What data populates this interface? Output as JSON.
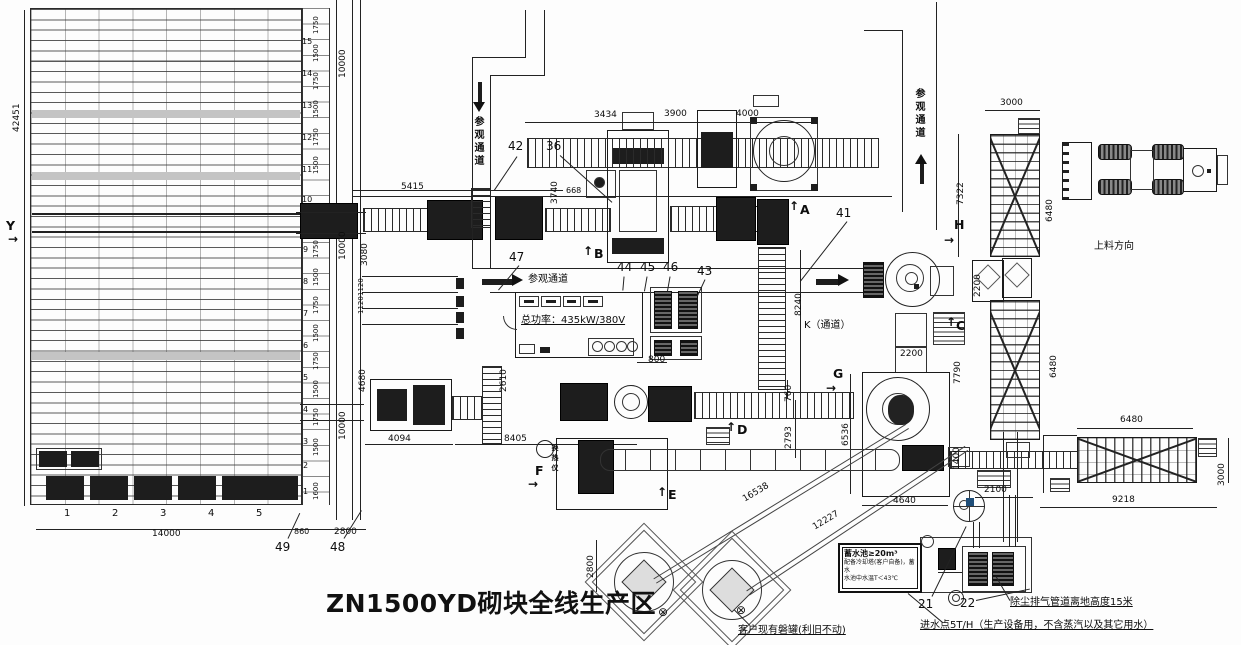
{
  "title": "ZN1500YD砌块全线生产区",
  "labels": {
    "water_box": {
      "l1": "蓄水池≥20m³",
      "l2": "配备冷却塔(客户自备)，蓄水",
      "l3": "水池中水温T＜43℃"
    }
  },
  "annotations": [
    {
      "t": "5415",
      "x": 401,
      "y": 183
    },
    {
      "t": "3434",
      "x": 594,
      "y": 111
    },
    {
      "t": "3900",
      "x": 664,
      "y": 110
    },
    {
      "t": "4000",
      "x": 736,
      "y": 110
    },
    {
      "t": "3000",
      "x": 1000,
      "y": 99
    },
    {
      "t": "2200",
      "x": 900,
      "y": 350
    },
    {
      "t": "800",
      "x": 648,
      "y": 356
    },
    {
      "t": "668",
      "x": 566,
      "y": 187,
      "s": 8
    },
    {
      "t": "2100",
      "x": 984,
      "y": 486
    },
    {
      "t": "4640",
      "x": 893,
      "y": 497
    },
    {
      "t": "4094",
      "x": 388,
      "y": 435
    },
    {
      "t": "8405",
      "x": 504,
      "y": 435
    },
    {
      "t": "14000",
      "x": 152,
      "y": 530
    },
    {
      "t": "860",
      "x": 294,
      "y": 528,
      "s": 8
    },
    {
      "t": "2800",
      "x": 334,
      "y": 528
    },
    {
      "t": "6480",
      "x": 1120,
      "y": 416
    },
    {
      "t": "9218",
      "x": 1112,
      "y": 496
    },
    {
      "t": "42451",
      "x": 13,
      "y": 132,
      "c": "v"
    },
    {
      "t": "10000",
      "x": 339,
      "y": 78,
      "c": "v"
    },
    {
      "t": "10000",
      "x": 339,
      "y": 260,
      "c": "v"
    },
    {
      "t": "10000",
      "x": 339,
      "y": 440,
      "c": "v"
    },
    {
      "t": "3080",
      "x": 361,
      "y": 266,
      "c": "v"
    },
    {
      "t": "1120",
      "x": 358,
      "y": 296,
      "c": "v",
      "s": 7
    },
    {
      "t": "1120",
      "x": 358,
      "y": 314,
      "c": "v",
      "s": 7
    },
    {
      "t": "4680",
      "x": 359,
      "y": 392,
      "c": "v"
    },
    {
      "t": "3740",
      "x": 551,
      "y": 204,
      "c": "v"
    },
    {
      "t": "8240",
      "x": 795,
      "y": 316,
      "c": "v"
    },
    {
      "t": "760",
      "x": 785,
      "y": 402,
      "c": "v"
    },
    {
      "t": "2793",
      "x": 785,
      "y": 449,
      "c": "v"
    },
    {
      "t": "2610",
      "x": 500,
      "y": 392,
      "c": "v"
    },
    {
      "t": "6536",
      "x": 842,
      "y": 446,
      "c": "v"
    },
    {
      "t": "7322",
      "x": 957,
      "y": 205,
      "c": "v"
    },
    {
      "t": "6480",
      "x": 1046,
      "y": 222,
      "c": "v"
    },
    {
      "t": "6480",
      "x": 1050,
      "y": 378,
      "c": "v"
    },
    {
      "t": "2200",
      "x": 974,
      "y": 297,
      "c": "v"
    },
    {
      "t": "7790",
      "x": 954,
      "y": 384,
      "c": "v"
    },
    {
      "t": "1400",
      "x": 953,
      "y": 470,
      "c": "v"
    },
    {
      "t": "3000",
      "x": 1218,
      "y": 486,
      "c": "v"
    },
    {
      "t": "2800",
      "x": 587,
      "y": 578,
      "c": "v"
    },
    {
      "t": "1600",
      "x": 313,
      "y": 500,
      "c": "v",
      "s": 7
    },
    {
      "t": "1750",
      "x": 313,
      "y": 34,
      "c": "v",
      "s": 7
    },
    {
      "t": "1500",
      "x": 313,
      "y": 62,
      "c": "v",
      "s": 7
    },
    {
      "t": "1750",
      "x": 313,
      "y": 90,
      "c": "v",
      "s": 7
    },
    {
      "t": "1500",
      "x": 313,
      "y": 118,
      "c": "v",
      "s": 7
    },
    {
      "t": "1750",
      "x": 313,
      "y": 146,
      "c": "v",
      "s": 7
    },
    {
      "t": "1500",
      "x": 313,
      "y": 174,
      "c": "v",
      "s": 7
    },
    {
      "t": "1750",
      "x": 313,
      "y": 258,
      "c": "v",
      "s": 7
    },
    {
      "t": "1500",
      "x": 313,
      "y": 286,
      "c": "v",
      "s": 7
    },
    {
      "t": "1750",
      "x": 313,
      "y": 314,
      "c": "v",
      "s": 7
    },
    {
      "t": "1500",
      "x": 313,
      "y": 342,
      "c": "v",
      "s": 7
    },
    {
      "t": "1750",
      "x": 313,
      "y": 370,
      "c": "v",
      "s": 7
    },
    {
      "t": "1500",
      "x": 313,
      "y": 398,
      "c": "v",
      "s": 7
    },
    {
      "t": "1750",
      "x": 313,
      "y": 426,
      "c": "v",
      "s": 7
    },
    {
      "t": "1500",
      "x": 313,
      "y": 456,
      "c": "v",
      "s": 7
    },
    {
      "t": "15",
      "x": 302,
      "y": 38,
      "s": 8,
      "n": "row-number"
    },
    {
      "t": "14",
      "x": 302,
      "y": 70,
      "s": 8,
      "n": "row-number"
    },
    {
      "t": "13",
      "x": 302,
      "y": 102,
      "s": 8,
      "n": "row-number"
    },
    {
      "t": "12",
      "x": 302,
      "y": 134,
      "s": 8,
      "n": "row-number"
    },
    {
      "t": "11",
      "x": 302,
      "y": 166,
      "s": 8,
      "n": "row-number"
    },
    {
      "t": "10",
      "x": 302,
      "y": 196,
      "s": 8,
      "n": "row-number"
    },
    {
      "t": "9",
      "x": 303,
      "y": 246,
      "s": 8,
      "n": "row-number"
    },
    {
      "t": "8",
      "x": 303,
      "y": 278,
      "s": 8,
      "n": "row-number"
    },
    {
      "t": "7",
      "x": 303,
      "y": 310,
      "s": 8,
      "n": "row-number"
    },
    {
      "t": "6",
      "x": 303,
      "y": 342,
      "s": 8,
      "n": "row-number"
    },
    {
      "t": "5",
      "x": 303,
      "y": 374,
      "s": 8,
      "n": "row-number"
    },
    {
      "t": "4",
      "x": 303,
      "y": 406,
      "s": 8,
      "n": "row-number"
    },
    {
      "t": "3",
      "x": 303,
      "y": 438,
      "s": 8,
      "n": "row-number"
    },
    {
      "t": "2",
      "x": 303,
      "y": 462,
      "s": 8,
      "n": "row-number"
    },
    {
      "t": "1",
      "x": 303,
      "y": 488,
      "s": 8,
      "n": "row-number"
    },
    {
      "t": "1",
      "x": 64,
      "y": 509,
      "s": 10,
      "n": "bay-number"
    },
    {
      "t": "2",
      "x": 112,
      "y": 509,
      "s": 10,
      "n": "bay-number"
    },
    {
      "t": "3",
      "x": 160,
      "y": 509,
      "s": 10,
      "n": "bay-number"
    },
    {
      "t": "4",
      "x": 208,
      "y": 509,
      "s": 10,
      "n": "bay-number"
    },
    {
      "t": "5",
      "x": 256,
      "y": 509,
      "s": 10,
      "n": "bay-number"
    },
    {
      "t": "16538",
      "x": 744,
      "y": 496,
      "r": -31
    },
    {
      "t": "12227",
      "x": 814,
      "y": 524,
      "r": -31
    },
    {
      "t": "参观通道",
      "x": 472,
      "y": 116,
      "c": "cn",
      "s": 10,
      "n": "passage-label"
    },
    {
      "t": "参观通道",
      "x": 913,
      "y": 88,
      "c": "cn",
      "s": 10,
      "n": "passage-label"
    },
    {
      "t": "参观通道",
      "x": 528,
      "y": 275,
      "s": 10,
      "n": "passage-label"
    },
    {
      "t": "上料方向",
      "x": 1094,
      "y": 242,
      "s": 10,
      "n": "loading-direction-label"
    },
    {
      "t": "K（通道）",
      "x": 804,
      "y": 321,
      "s": 10,
      "n": "k-passage-label"
    },
    {
      "t": "总功率：435kW/380V",
      "x": 521,
      "y": 316,
      "s": 10,
      "c": "u",
      "n": "total-power-label"
    },
    {
      "t": "换热仪",
      "x": 551,
      "y": 444,
      "c": "cn",
      "s": 7,
      "n": "heat-exchanger-label"
    },
    {
      "t": "客户现有磐罐(利旧不动)",
      "x": 738,
      "y": 626,
      "s": 10,
      "c": "u",
      "n": "existing-tank-note"
    },
    {
      "t": "除尘排气管道离地高度15米",
      "x": 1010,
      "y": 598,
      "s": 10,
      "c": "u",
      "n": "dust-pipe-note"
    },
    {
      "t": "进水点5T/H（生产设备用，不含蒸汽以及其它用水）",
      "x": 920,
      "y": 621,
      "s": 10,
      "c": "u",
      "n": "water-inlet-note"
    },
    {
      "t": "42",
      "x": 508,
      "y": 140,
      "c": "num",
      "n": "item-number"
    },
    {
      "t": "36",
      "x": 546,
      "y": 140,
      "c": "num",
      "n": "item-number"
    },
    {
      "t": "41",
      "x": 836,
      "y": 207,
      "c": "num",
      "n": "item-number"
    },
    {
      "t": "47",
      "x": 509,
      "y": 251,
      "c": "num",
      "n": "item-number"
    },
    {
      "t": "44",
      "x": 617,
      "y": 261,
      "c": "num",
      "n": "item-number"
    },
    {
      "t": "45",
      "x": 640,
      "y": 261,
      "c": "num",
      "n": "item-number"
    },
    {
      "t": "46",
      "x": 663,
      "y": 261,
      "c": "num",
      "n": "item-number"
    },
    {
      "t": "43",
      "x": 697,
      "y": 265,
      "c": "num",
      "n": "item-number"
    },
    {
      "t": "48",
      "x": 330,
      "y": 541,
      "c": "num",
      "n": "item-number"
    },
    {
      "t": "49",
      "x": 275,
      "y": 541,
      "c": "num",
      "n": "item-number"
    },
    {
      "t": "21",
      "x": 918,
      "y": 598,
      "c": "num",
      "n": "item-number"
    },
    {
      "t": "22",
      "x": 960,
      "y": 597,
      "c": "num",
      "n": "item-number"
    },
    {
      "t": "Y",
      "x": 6,
      "y": 220,
      "c": "sec",
      "n": "section-label"
    },
    {
      "t": "A",
      "x": 800,
      "y": 204,
      "c": "sec",
      "n": "section-label"
    },
    {
      "t": "B",
      "x": 594,
      "y": 248,
      "c": "sec",
      "n": "section-label"
    },
    {
      "t": "C",
      "x": 956,
      "y": 320,
      "c": "sec",
      "n": "section-label"
    },
    {
      "t": "D",
      "x": 737,
      "y": 424,
      "c": "sec",
      "n": "section-label"
    },
    {
      "t": "E",
      "x": 668,
      "y": 489,
      "c": "sec",
      "n": "section-label"
    },
    {
      "t": "F",
      "x": 535,
      "y": 465,
      "c": "sec",
      "n": "section-label"
    },
    {
      "t": "G",
      "x": 833,
      "y": 368,
      "c": "sec",
      "n": "section-label"
    },
    {
      "t": "H",
      "x": 954,
      "y": 219,
      "c": "sec",
      "n": "section-label"
    },
    {
      "t": "↑",
      "x": 789,
      "y": 200,
      "c": "sarr",
      "n": "section-arrow"
    },
    {
      "t": "↑",
      "x": 583,
      "y": 245,
      "c": "sarr",
      "n": "section-arrow"
    },
    {
      "t": "↑",
      "x": 946,
      "y": 316,
      "c": "sarr",
      "n": "section-arrow"
    },
    {
      "t": "↑",
      "x": 726,
      "y": 421,
      "c": "sarr",
      "n": "section-arrow"
    },
    {
      "t": "↑",
      "x": 657,
      "y": 486,
      "c": "sarr",
      "n": "section-arrow"
    },
    {
      "t": "→",
      "x": 528,
      "y": 478,
      "c": "sarr",
      "n": "section-arrow"
    },
    {
      "t": "→",
      "x": 826,
      "y": 382,
      "c": "sarr",
      "n": "section-arrow"
    },
    {
      "t": "→",
      "x": 944,
      "y": 234,
      "c": "sarr",
      "n": "section-arrow"
    },
    {
      "t": "→",
      "x": 8,
      "y": 233,
      "c": "sarr",
      "n": "section-arrow"
    },
    {
      "t": "⊗",
      "x": 658,
      "y": 606,
      "s": 12,
      "n": "valve-symbol"
    },
    {
      "t": "⊗",
      "x": 736,
      "y": 604,
      "s": 12,
      "n": "valve-symbol"
    }
  ],
  "leaders": [
    {
      "x": 517,
      "y": 156,
      "r": 124,
      "len": 41
    },
    {
      "x": 560,
      "y": 155,
      "r": 42,
      "len": 70
    },
    {
      "x": 847,
      "y": 221,
      "r": 128,
      "len": 76
    },
    {
      "x": 519,
      "y": 265,
      "r": 130,
      "len": 32
    },
    {
      "x": 624,
      "y": 276,
      "r": 95,
      "len": 14
    },
    {
      "x": 647,
      "y": 276,
      "r": 100,
      "len": 15
    },
    {
      "x": 670,
      "y": 276,
      "r": 100,
      "len": 15
    },
    {
      "x": 705,
      "y": 279,
      "r": 115,
      "len": 18
    },
    {
      "x": 344,
      "y": 538,
      "r": -58,
      "len": 33
    },
    {
      "x": 288,
      "y": 538,
      "r": -65,
      "len": 28
    },
    {
      "x": 932,
      "y": 596,
      "r": -64,
      "len": 78
    },
    {
      "x": 976,
      "y": 600,
      "r": -12,
      "len": 55
    },
    {
      "x": 908,
      "y": 593,
      "r": 40,
      "len": 45
    },
    {
      "x": 750,
      "y": 625,
      "r": -135,
      "len": 22
    },
    {
      "x": 1010,
      "y": 600,
      "r": -120,
      "len": 28
    }
  ]
}
